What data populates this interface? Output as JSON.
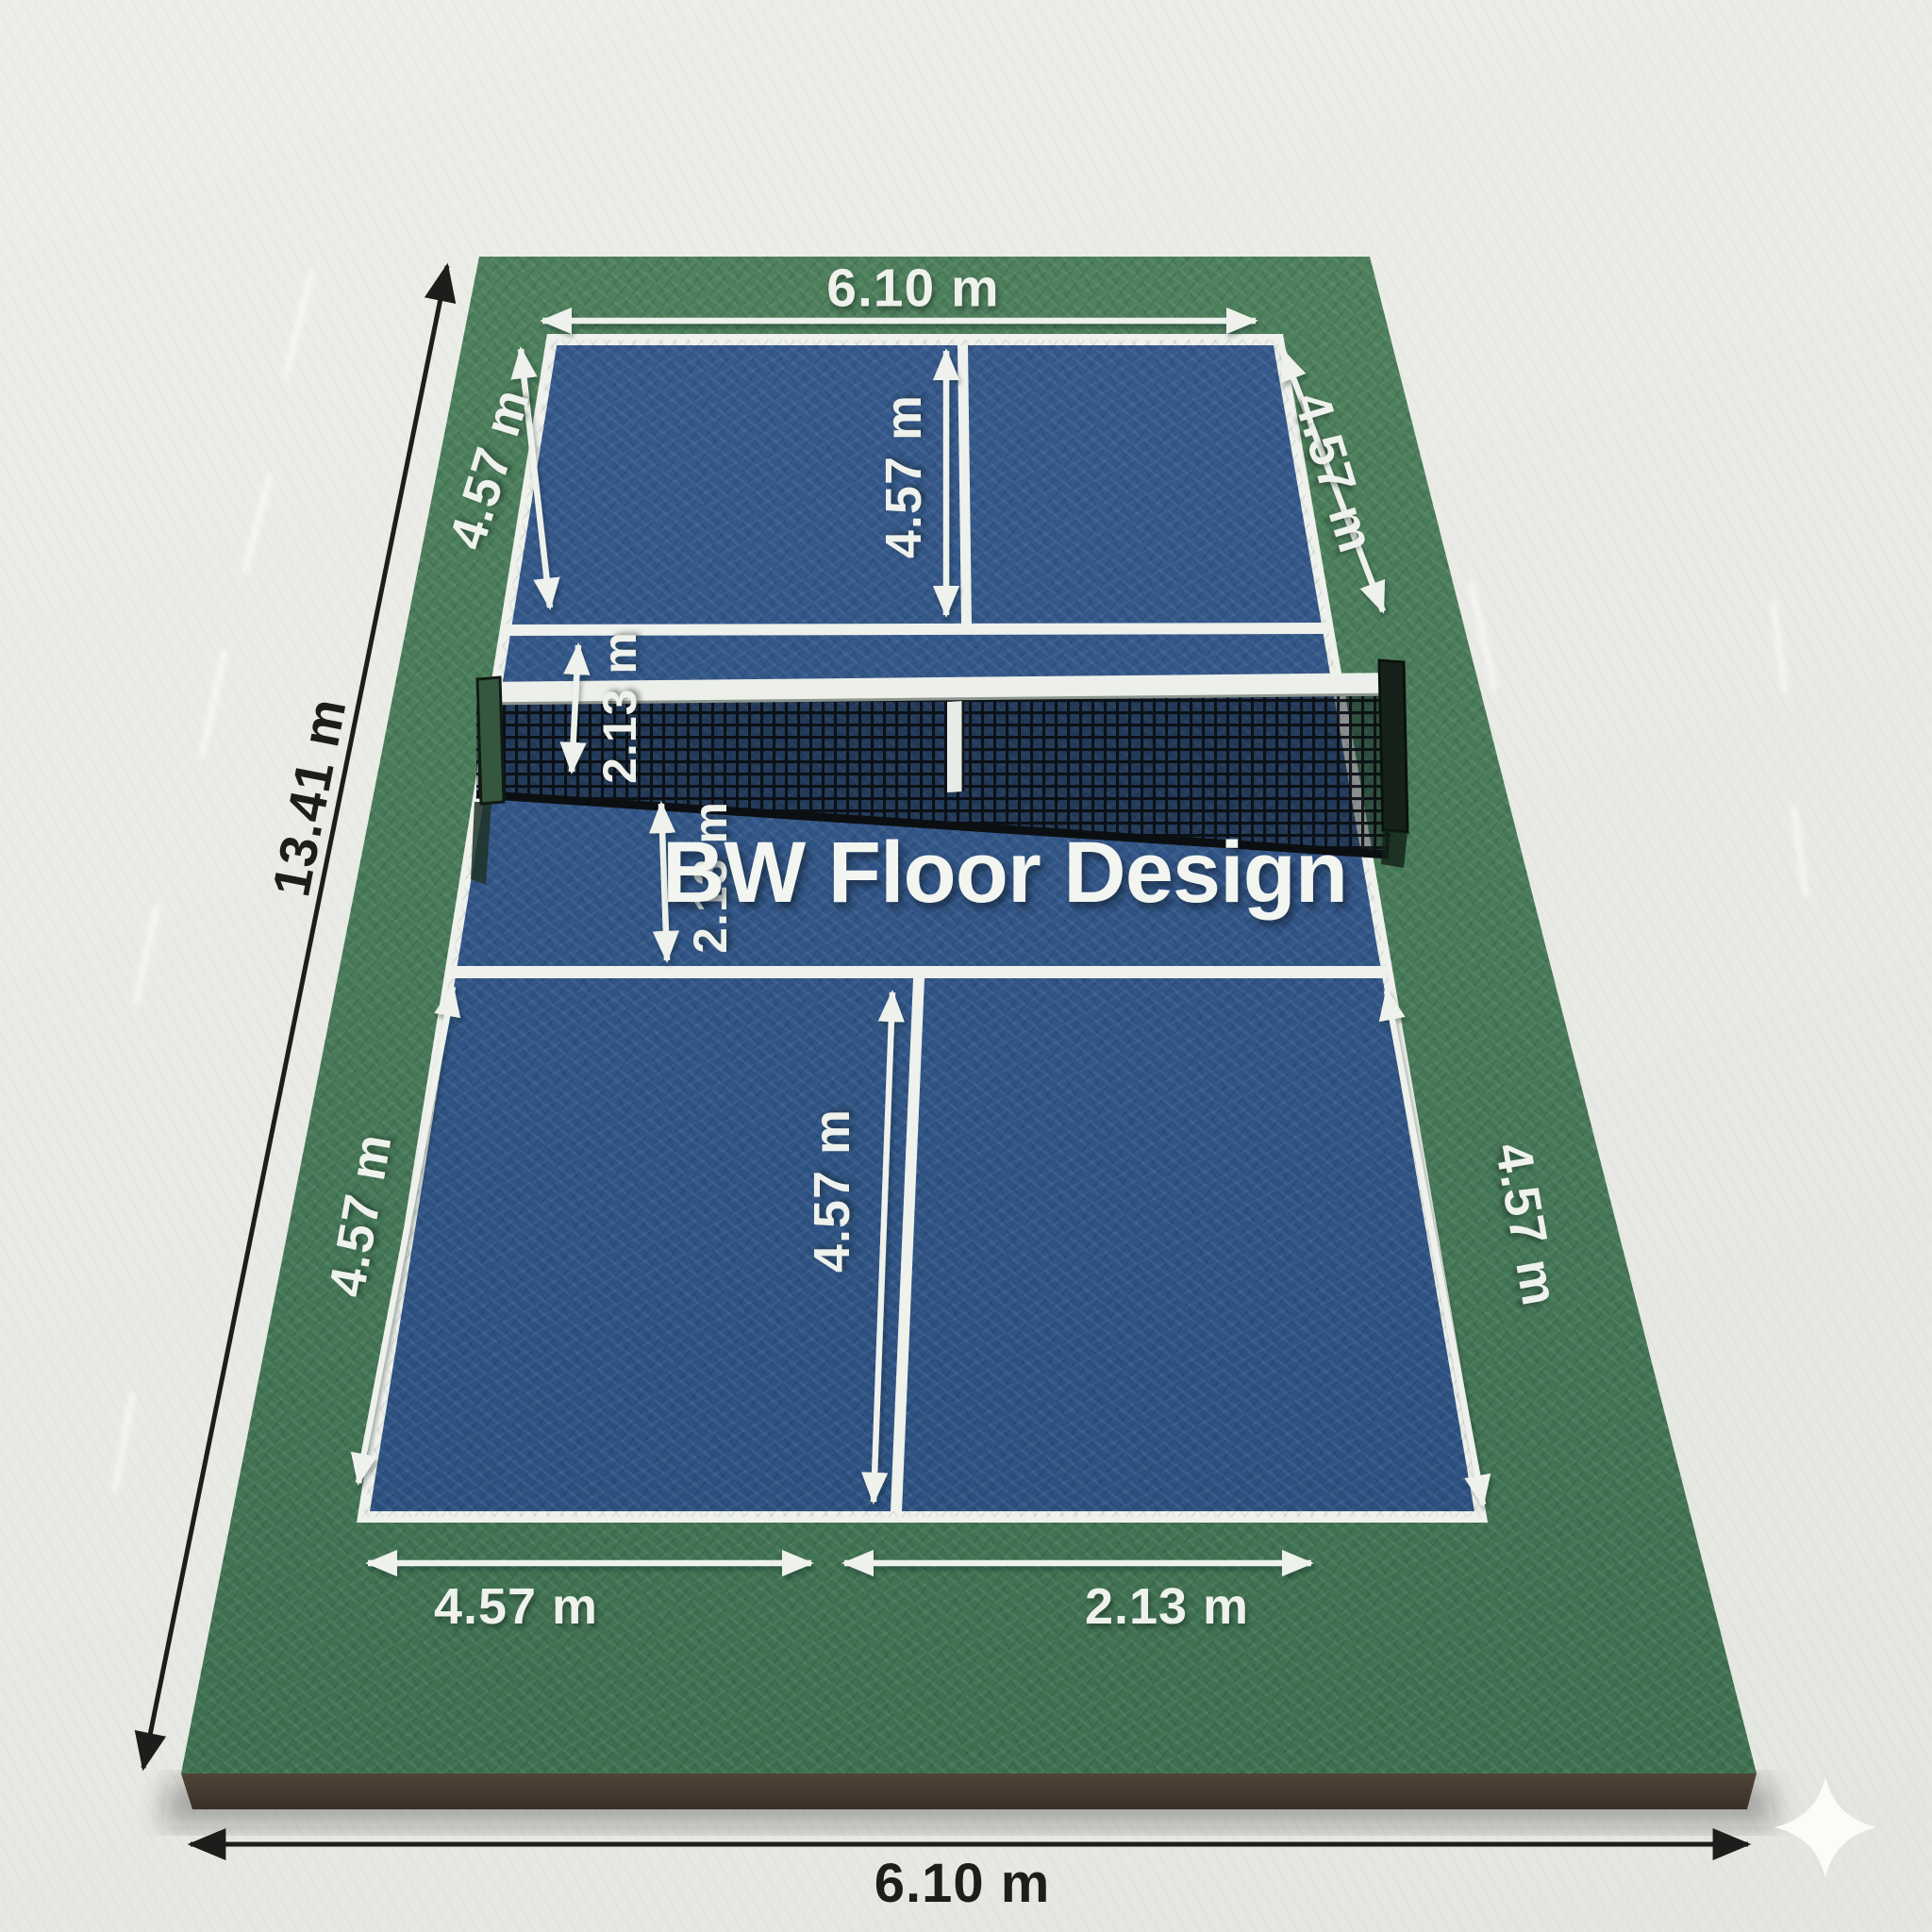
{
  "title": "Pickleball court floor render with dimensions",
  "brand": {
    "name": "BW Floor Design"
  },
  "dimensions": {
    "top_width": "6.10 m",
    "upper_left_side": "4.57 m",
    "upper_right_side": "4.57 m",
    "upper_service_depth": "4.57 m",
    "upper_non_volley_zone": "2.13 m",
    "lower_non_volley_zone": "2.13 m",
    "lower_service_depth": "4.57 m",
    "lower_left_side": "4.57 m",
    "lower_right_side": "4.57 m",
    "bottom_width_left_segment": "4.57 m",
    "bottom_width_right_segment": "2.13 m",
    "total_length": "13.41 m",
    "total_width": "6.10 m"
  },
  "icons": {
    "sparkle": "four-point-sparkle"
  },
  "colors": {
    "background": "#e9eae5",
    "turf_green": "#47795a",
    "court_blue": "#2f5587",
    "line_white": "#eef1ec",
    "base_brown": "#4a3d31",
    "ink_black": "#1d1d1b"
  }
}
